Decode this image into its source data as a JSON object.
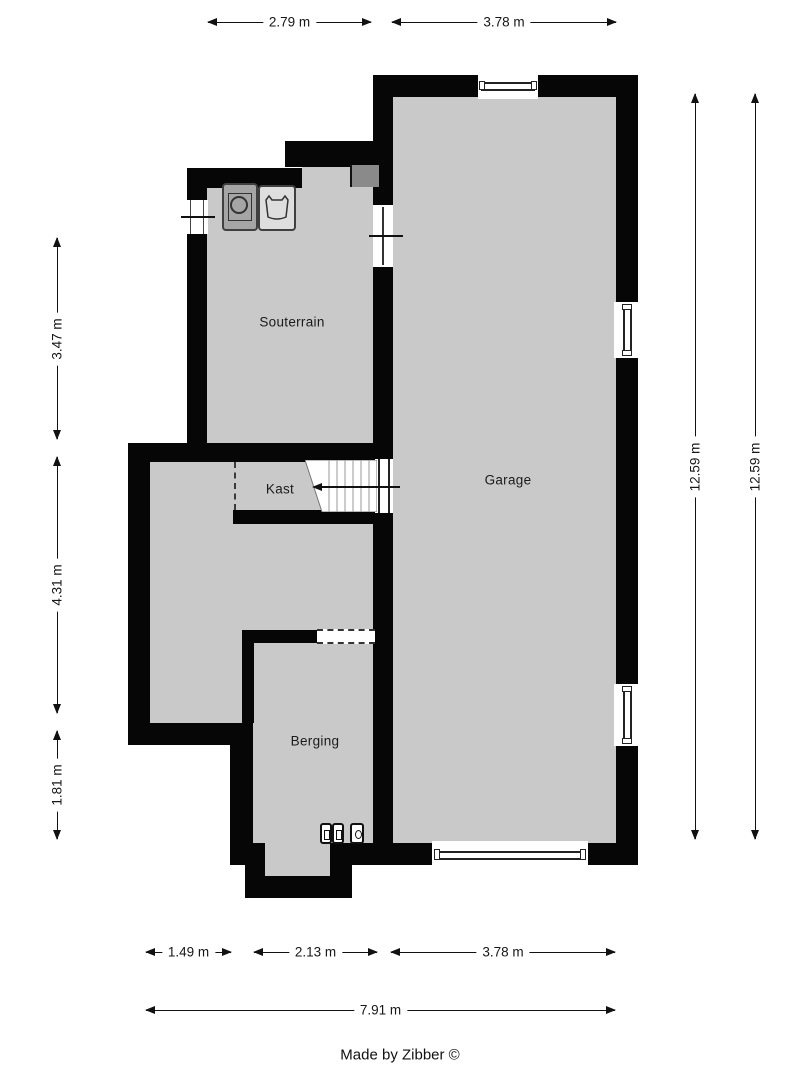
{
  "rooms": [
    {
      "name": "souterrain",
      "label": "Souterrain"
    },
    {
      "name": "kast",
      "label": "Kast"
    },
    {
      "name": "garage",
      "label": "Garage"
    },
    {
      "name": "berging",
      "label": "Berging"
    }
  ],
  "dimensions": {
    "top": [
      "2.79 m",
      "3.78 m"
    ],
    "left": [
      "3.47 m",
      "4.31 m",
      "1.81 m"
    ],
    "right": [
      "12.59 m",
      "12.59 m"
    ],
    "bottom": [
      "1.49 m",
      "2.13 m",
      "3.78 m"
    ],
    "bottom_total": "7.91 m"
  },
  "fixtures": [
    "washing-machine-icon",
    "laundry-sink-icon",
    "duct-block",
    "stairs-up",
    "meter-icons",
    "window",
    "garage-door"
  ],
  "stairs": {
    "direction_arrow": "left"
  },
  "footer": {
    "credit": "Made by Zibber ©"
  },
  "colors": {
    "wall": "#060606",
    "floor": "#c9c9c9",
    "duct_block": "#8a8a8a",
    "dimension_line": "#111111",
    "label_text": "#1b1b1b"
  }
}
